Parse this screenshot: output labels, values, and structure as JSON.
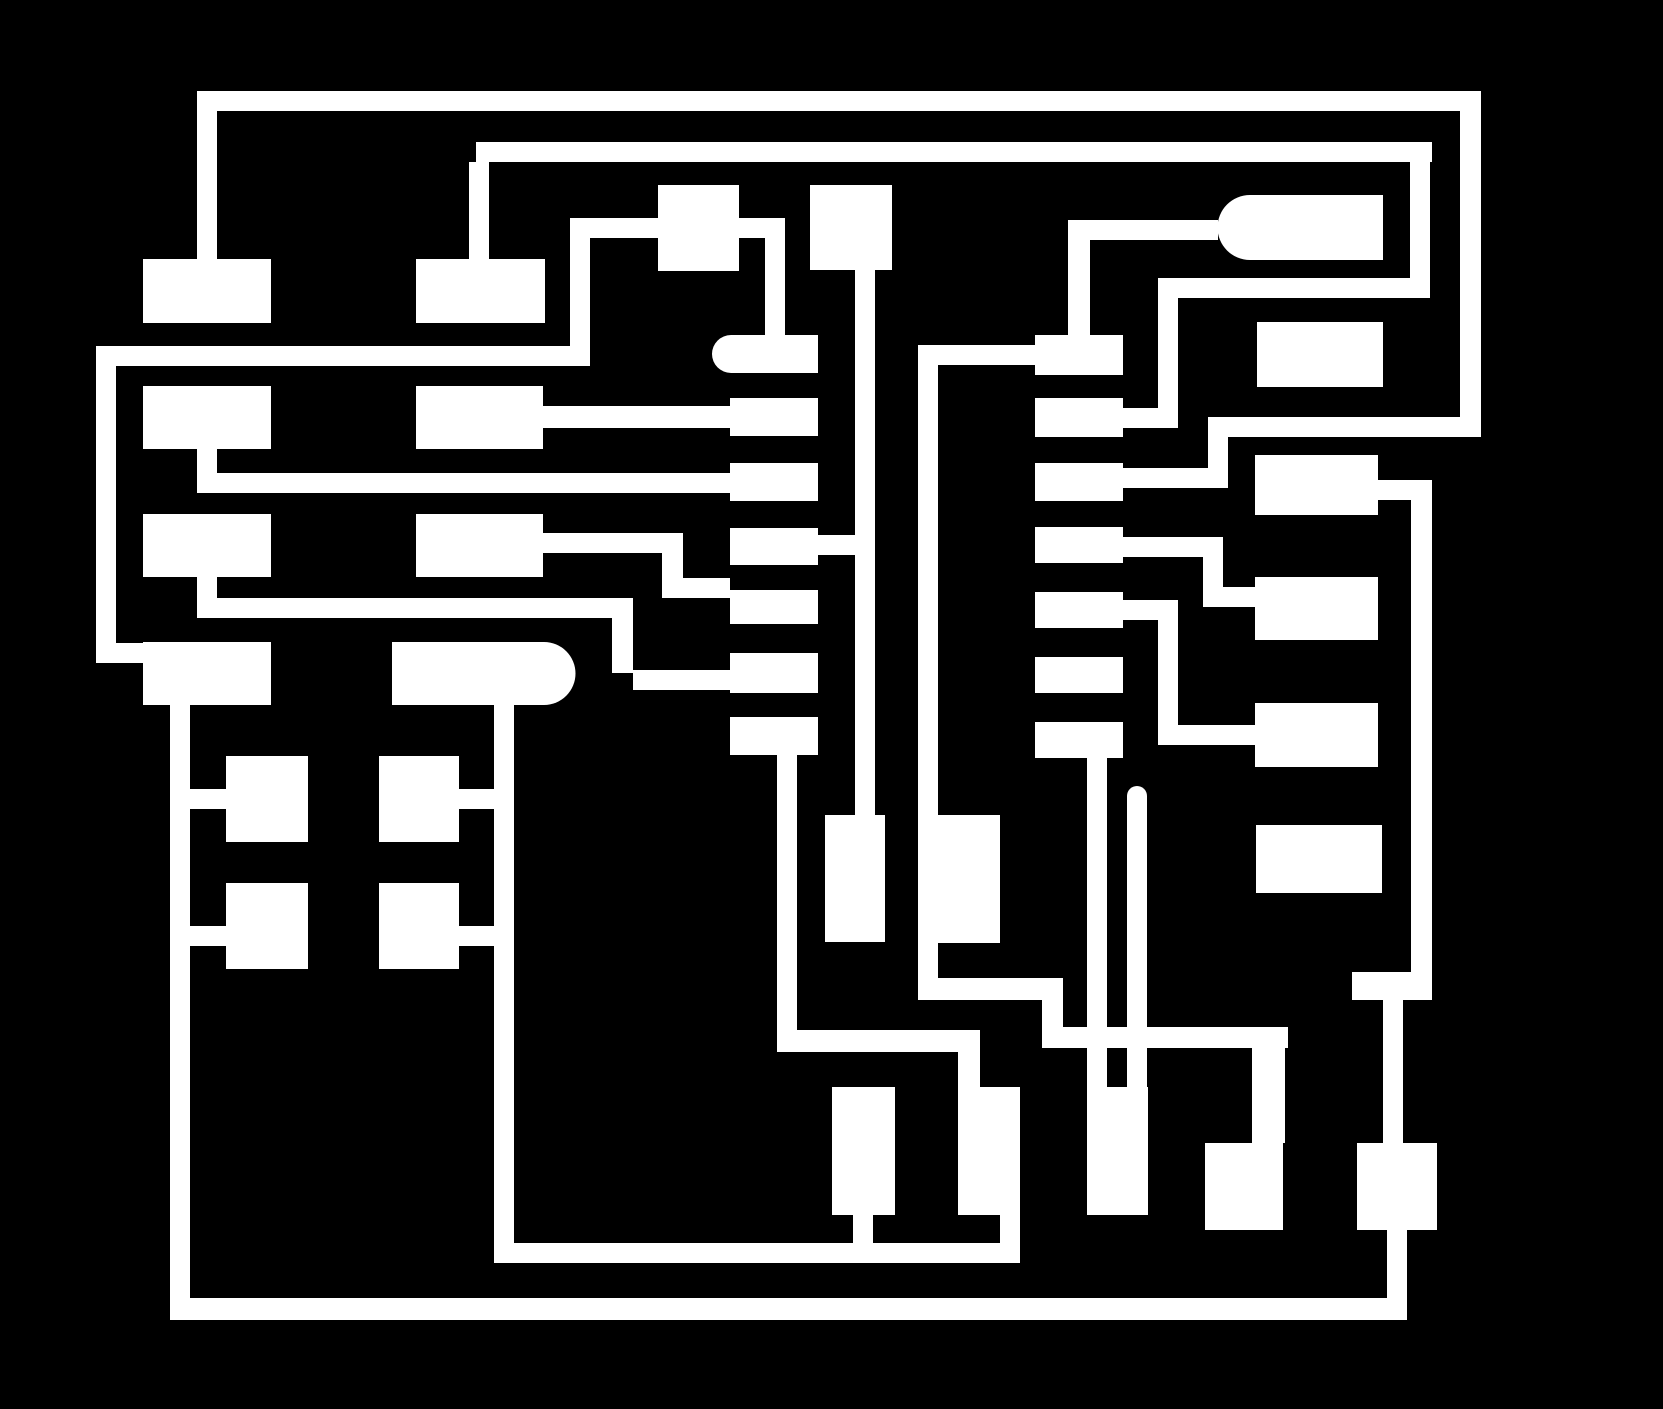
{
  "canvas": {
    "width": 1663,
    "height": 1409
  },
  "colors": {
    "background": "#000000",
    "copper": "#ffffff"
  },
  "board": {
    "description": "pcb-copper-trace-artwork",
    "pads": [
      {
        "name": "pad-left-col-row1",
        "x": 143,
        "y": 259,
        "w": 128,
        "h": 64
      },
      {
        "name": "pad-left-col-row2",
        "x": 143,
        "y": 386,
        "w": 128,
        "h": 63
      },
      {
        "name": "pad-left-col-row3",
        "x": 143,
        "y": 514,
        "w": 128,
        "h": 63
      },
      {
        "name": "pad-left-col-row4",
        "x": 143,
        "y": 642,
        "w": 128,
        "h": 63
      },
      {
        "name": "pad-mid-col-row1",
        "x": 416,
        "y": 259,
        "w": 129,
        "h": 64
      },
      {
        "name": "pad-mid-col-row2",
        "x": 416,
        "y": 386,
        "w": 127,
        "h": 63
      },
      {
        "name": "pad-mid-col-row3",
        "x": 416,
        "y": 514,
        "w": 127,
        "h": 63
      },
      {
        "name": "pad-stadium-row4",
        "x": 392,
        "y": 642,
        "w": 152,
        "h": 63,
        "cap": "right",
        "capR": 31.5
      },
      {
        "name": "pad-top-square-a",
        "x": 658,
        "y": 185,
        "w": 81,
        "h": 86
      },
      {
        "name": "pad-top-square-b",
        "x": 810,
        "y": 185,
        "w": 82,
        "h": 85
      },
      {
        "name": "pad-ic-left-row1-rounded",
        "x": 731,
        "y": 335,
        "w": 87,
        "h": 38,
        "cap": "left",
        "capR": 19
      },
      {
        "name": "pad-ic-left-row2",
        "x": 730,
        "y": 398,
        "w": 88,
        "h": 38
      },
      {
        "name": "pad-ic-left-row3",
        "x": 730,
        "y": 463,
        "w": 88,
        "h": 38
      },
      {
        "name": "pad-ic-left-row4",
        "x": 730,
        "y": 528,
        "w": 88,
        "h": 37
      },
      {
        "name": "pad-ic-left-row5",
        "x": 730,
        "y": 590,
        "w": 88,
        "h": 34
      },
      {
        "name": "pad-ic-left-row6",
        "x": 730,
        "y": 653,
        "w": 88,
        "h": 40
      },
      {
        "name": "pad-ic-left-row7",
        "x": 730,
        "y": 717,
        "w": 88,
        "h": 38
      },
      {
        "name": "pad-ic-right-row1",
        "x": 1035,
        "y": 335,
        "w": 88,
        "h": 40
      },
      {
        "name": "pad-ic-right-row2",
        "x": 1035,
        "y": 398,
        "w": 88,
        "h": 39
      },
      {
        "name": "pad-ic-right-row3",
        "x": 1035,
        "y": 463,
        "w": 88,
        "h": 38
      },
      {
        "name": "pad-ic-right-row4",
        "x": 1035,
        "y": 527,
        "w": 88,
        "h": 36
      },
      {
        "name": "pad-ic-right-row5",
        "x": 1035,
        "y": 592,
        "w": 88,
        "h": 36
      },
      {
        "name": "pad-ic-right-row6",
        "x": 1035,
        "y": 657,
        "w": 88,
        "h": 36
      },
      {
        "name": "pad-ic-right-row7",
        "x": 1035,
        "y": 722,
        "w": 88,
        "h": 36
      },
      {
        "name": "pad-bullet-top-right",
        "x": 1250,
        "y": 195,
        "w": 133,
        "h": 65,
        "cap": "left",
        "capR": 32.5
      },
      {
        "name": "pad-right-col-row1",
        "x": 1257,
        "y": 322,
        "w": 126,
        "h": 65
      },
      {
        "name": "pad-right-col-row2",
        "x": 1255,
        "y": 455,
        "w": 123,
        "h": 60
      },
      {
        "name": "pad-right-col-row3",
        "x": 1255,
        "y": 577,
        "w": 123,
        "h": 63
      },
      {
        "name": "pad-right-col-row4",
        "x": 1255,
        "y": 703,
        "w": 123,
        "h": 64
      },
      {
        "name": "pad-right-col-row5",
        "x": 1256,
        "y": 825,
        "w": 126,
        "h": 68
      },
      {
        "name": "pad-grid-row1-left",
        "x": 226,
        "y": 756,
        "w": 82,
        "h": 86
      },
      {
        "name": "pad-grid-row1-right",
        "x": 379,
        "y": 756,
        "w": 80,
        "h": 86
      },
      {
        "name": "pad-grid-row2-left",
        "x": 226,
        "y": 883,
        "w": 82,
        "h": 86
      },
      {
        "name": "pad-grid-row2-right",
        "x": 379,
        "y": 883,
        "w": 80,
        "h": 86
      },
      {
        "name": "pad-tall-mid-a",
        "x": 825,
        "y": 815,
        "w": 60,
        "h": 127
      },
      {
        "name": "pad-tall-mid-b",
        "x": 938,
        "y": 815,
        "w": 62,
        "h": 128
      },
      {
        "name": "pad-bottom-row-a",
        "x": 832,
        "y": 1087,
        "w": 63,
        "h": 128
      },
      {
        "name": "pad-bottom-row-b",
        "x": 958,
        "y": 1087,
        "w": 62,
        "h": 128
      },
      {
        "name": "pad-bottom-row-c",
        "x": 1087,
        "y": 1087,
        "w": 61,
        "h": 128
      },
      {
        "name": "pad-bottom-row-d",
        "x": 1205,
        "y": 1143,
        "w": 78,
        "h": 87
      },
      {
        "name": "pad-bottom-row-e",
        "x": 1357,
        "y": 1143,
        "w": 80,
        "h": 87
      }
    ],
    "traces": [
      {
        "name": "trace-top-rail",
        "x": 199,
        "y": 91,
        "w": 1282,
        "h": 20
      },
      {
        "name": "trace-top-rail-left-drop",
        "x": 197,
        "y": 91,
        "w": 20,
        "h": 168
      },
      {
        "name": "trace-right-edge-vert",
        "x": 1460,
        "y": 91,
        "w": 21,
        "h": 346
      },
      {
        "name": "trace-right-return-horiz",
        "x": 1208,
        "y": 417,
        "w": 273,
        "h": 20
      },
      {
        "name": "trace-right-return-jog",
        "x": 1208,
        "y": 417,
        "w": 20,
        "h": 71
      },
      {
        "name": "trace-icR3-connector",
        "x": 1123,
        "y": 468,
        "w": 105,
        "h": 20
      },
      {
        "name": "trace-second-rail",
        "x": 476,
        "y": 142,
        "w": 956,
        "h": 20
      },
      {
        "name": "trace-second-rail-drop",
        "x": 469,
        "y": 162,
        "w": 20,
        "h": 97
      },
      {
        "name": "trace-second-rail-rvert",
        "x": 1410,
        "y": 162,
        "w": 20,
        "h": 136
      },
      {
        "name": "trace-second-return-horiz",
        "x": 1158,
        "y": 278,
        "w": 272,
        "h": 20
      },
      {
        "name": "trace-second-return-vert",
        "x": 1158,
        "y": 298,
        "w": 20,
        "h": 130
      },
      {
        "name": "trace-icR2-connector",
        "x": 1123,
        "y": 408,
        "w": 55,
        "h": 20
      },
      {
        "name": "trace-h2-horiz",
        "x": 96,
        "y": 346,
        "w": 494,
        "h": 20
      },
      {
        "name": "trace-h2-left-vert",
        "x": 96,
        "y": 346,
        "w": 20,
        "h": 317
      },
      {
        "name": "trace-h2-to-pad-l4",
        "x": 116,
        "y": 643,
        "w": 27,
        "h": 20
      },
      {
        "name": "trace-h2-right-vert",
        "x": 570,
        "y": 218,
        "w": 20,
        "h": 148
      },
      {
        "name": "trace-through-pad-a",
        "x": 570,
        "y": 218,
        "w": 215,
        "h": 20
      },
      {
        "name": "trace-pad-a-drop",
        "x": 765,
        "y": 238,
        "w": 20,
        "h": 97
      },
      {
        "name": "trace-row2-to-icL2",
        "x": 543,
        "y": 406,
        "w": 187,
        "h": 22
      },
      {
        "name": "trace-l2-stub",
        "x": 197,
        "y": 449,
        "w": 20,
        "h": 24
      },
      {
        "name": "trace-l2-to-icL3",
        "x": 197,
        "y": 473,
        "w": 533,
        "h": 20
      },
      {
        "name": "trace-l3-stub",
        "x": 197,
        "y": 577,
        "w": 20,
        "h": 21
      },
      {
        "name": "trace-l3-horiz",
        "x": 197,
        "y": 598,
        "w": 436,
        "h": 20
      },
      {
        "name": "trace-l3-jog-down",
        "x": 612,
        "y": 618,
        "w": 21,
        "h": 55
      },
      {
        "name": "trace-l3-to-icL6",
        "x": 633,
        "y": 670,
        "w": 97,
        "h": 20
      },
      {
        "name": "trace-row3-horiz",
        "x": 543,
        "y": 533,
        "w": 140,
        "h": 20
      },
      {
        "name": "trace-row3-jog-down",
        "x": 662,
        "y": 533,
        "w": 21,
        "h": 65
      },
      {
        "name": "trace-row3-to-icL5",
        "x": 683,
        "y": 578,
        "w": 47,
        "h": 20
      },
      {
        "name": "trace-icL4-to-v1",
        "x": 818,
        "y": 535,
        "w": 37,
        "h": 20
      },
      {
        "name": "trace-v1-center",
        "x": 855,
        "y": 270,
        "w": 20,
        "h": 545
      },
      {
        "name": "trace-v2-center",
        "x": 918,
        "y": 345,
        "w": 20,
        "h": 655
      },
      {
        "name": "trace-v2-to-icR1",
        "x": 938,
        "y": 345,
        "w": 97,
        "h": 20
      },
      {
        "name": "trace-icR1-up-stub",
        "x": 1068,
        "y": 220,
        "w": 22,
        "h": 115
      },
      {
        "name": "trace-bullet-feed",
        "x": 1068,
        "y": 220,
        "w": 150,
        "h": 20
      },
      {
        "name": "trace-icR4-horiz",
        "x": 1123,
        "y": 537,
        "w": 80,
        "h": 20
      },
      {
        "name": "trace-icR4-jog",
        "x": 1203,
        "y": 537,
        "w": 20,
        "h": 70
      },
      {
        "name": "trace-icR4-to-rc3",
        "x": 1203,
        "y": 587,
        "w": 52,
        "h": 20
      },
      {
        "name": "trace-icR5-horiz",
        "x": 1123,
        "y": 600,
        "w": 55,
        "h": 20
      },
      {
        "name": "trace-icR5-jog",
        "x": 1158,
        "y": 600,
        "w": 20,
        "h": 145
      },
      {
        "name": "trace-icR5-to-rc4",
        "x": 1158,
        "y": 725,
        "w": 97,
        "h": 20
      },
      {
        "name": "trace-rc2-stub",
        "x": 1378,
        "y": 480,
        "w": 33,
        "h": 20
      },
      {
        "name": "trace-v3-right-rail",
        "x": 1411,
        "y": 480,
        "w": 21,
        "h": 520
      },
      {
        "name": "trace-icL7-drop",
        "x": 777,
        "y": 755,
        "w": 20,
        "h": 297
      },
      {
        "name": "trace-icL7-horiz",
        "x": 777,
        "y": 1030,
        "w": 203,
        "h": 22
      },
      {
        "name": "trace-icL7-to-padB",
        "x": 958,
        "y": 1052,
        "w": 22,
        "h": 35
      },
      {
        "name": "trace-v2-bottom-horiz",
        "x": 918,
        "y": 978,
        "w": 145,
        "h": 22
      },
      {
        "name": "trace-v2-bottom-jog",
        "x": 1042,
        "y": 978,
        "w": 21,
        "h": 70
      },
      {
        "name": "trace-v2-bottom-horiz2",
        "x": 1042,
        "y": 1027,
        "w": 246,
        "h": 21
      },
      {
        "name": "trace-drop-to-padD",
        "x": 1252,
        "y": 1027,
        "w": 33,
        "h": 116
      },
      {
        "name": "trace-left-tall-rail",
        "x": 170,
        "y": 705,
        "w": 20,
        "h": 615
      },
      {
        "name": "trace-bottom-border",
        "x": 170,
        "y": 1298,
        "w": 1237,
        "h": 22
      },
      {
        "name": "trace-right-tall-rail",
        "x": 494,
        "y": 705,
        "w": 20,
        "h": 558
      },
      {
        "name": "trace-bottom-inner",
        "x": 494,
        "y": 1243,
        "w": 526,
        "h": 20
      },
      {
        "name": "trace-grid-r1-left-stub",
        "x": 190,
        "y": 789,
        "w": 36,
        "h": 20
      },
      {
        "name": "trace-grid-r1-right-stub",
        "x": 459,
        "y": 789,
        "w": 35,
        "h": 20
      },
      {
        "name": "trace-grid-r2-left-stub",
        "x": 190,
        "y": 926,
        "w": 36,
        "h": 20
      },
      {
        "name": "trace-grid-r2-right-stub",
        "x": 459,
        "y": 926,
        "w": 35,
        "h": 20
      },
      {
        "name": "trace-padA-bottom-stub",
        "x": 853,
        "y": 1215,
        "w": 20,
        "h": 28
      },
      {
        "name": "trace-padB-bottom-stub",
        "x": 1000,
        "y": 1215,
        "w": 20,
        "h": 28
      },
      {
        "name": "trace-icR7-spur",
        "x": 1087,
        "y": 758,
        "w": 20,
        "h": 329
      },
      {
        "name": "trace-round-cap-spur",
        "x": 1127,
        "y": 796,
        "w": 20,
        "h": 291,
        "cap": "top",
        "capR": 10
      },
      {
        "name": "trace-v3-bottom-jog",
        "x": 1352,
        "y": 972,
        "w": 80,
        "h": 28
      },
      {
        "name": "trace-v3-to-padE",
        "x": 1383,
        "y": 1000,
        "w": 20,
        "h": 143
      },
      {
        "name": "trace-padE-bottom-stub",
        "x": 1387,
        "y": 1230,
        "w": 20,
        "h": 90
      }
    ]
  }
}
